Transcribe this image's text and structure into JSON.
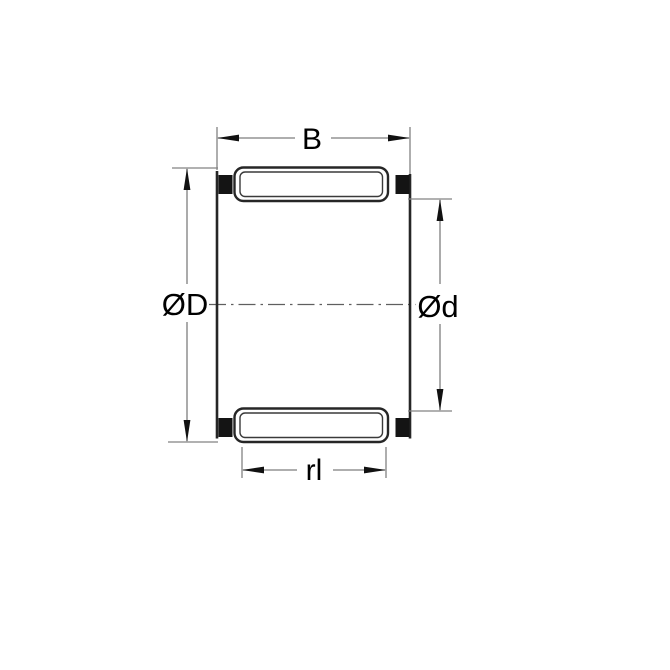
{
  "drawing": {
    "kind": "technical-drawing",
    "subject": "needle-roller-bearing-cage-assembly-cross-section",
    "labels": {
      "width": "B",
      "outer_diameter": "ØD",
      "inner_diameter": "Ød",
      "roller_length": "rl"
    },
    "colors": {
      "background": "#ffffff",
      "outline": "#262626",
      "block_fill": "#141414",
      "dimension_line": "#7e7e7e",
      "center_line": "#5f5f5f",
      "text": "#000000"
    }
  }
}
